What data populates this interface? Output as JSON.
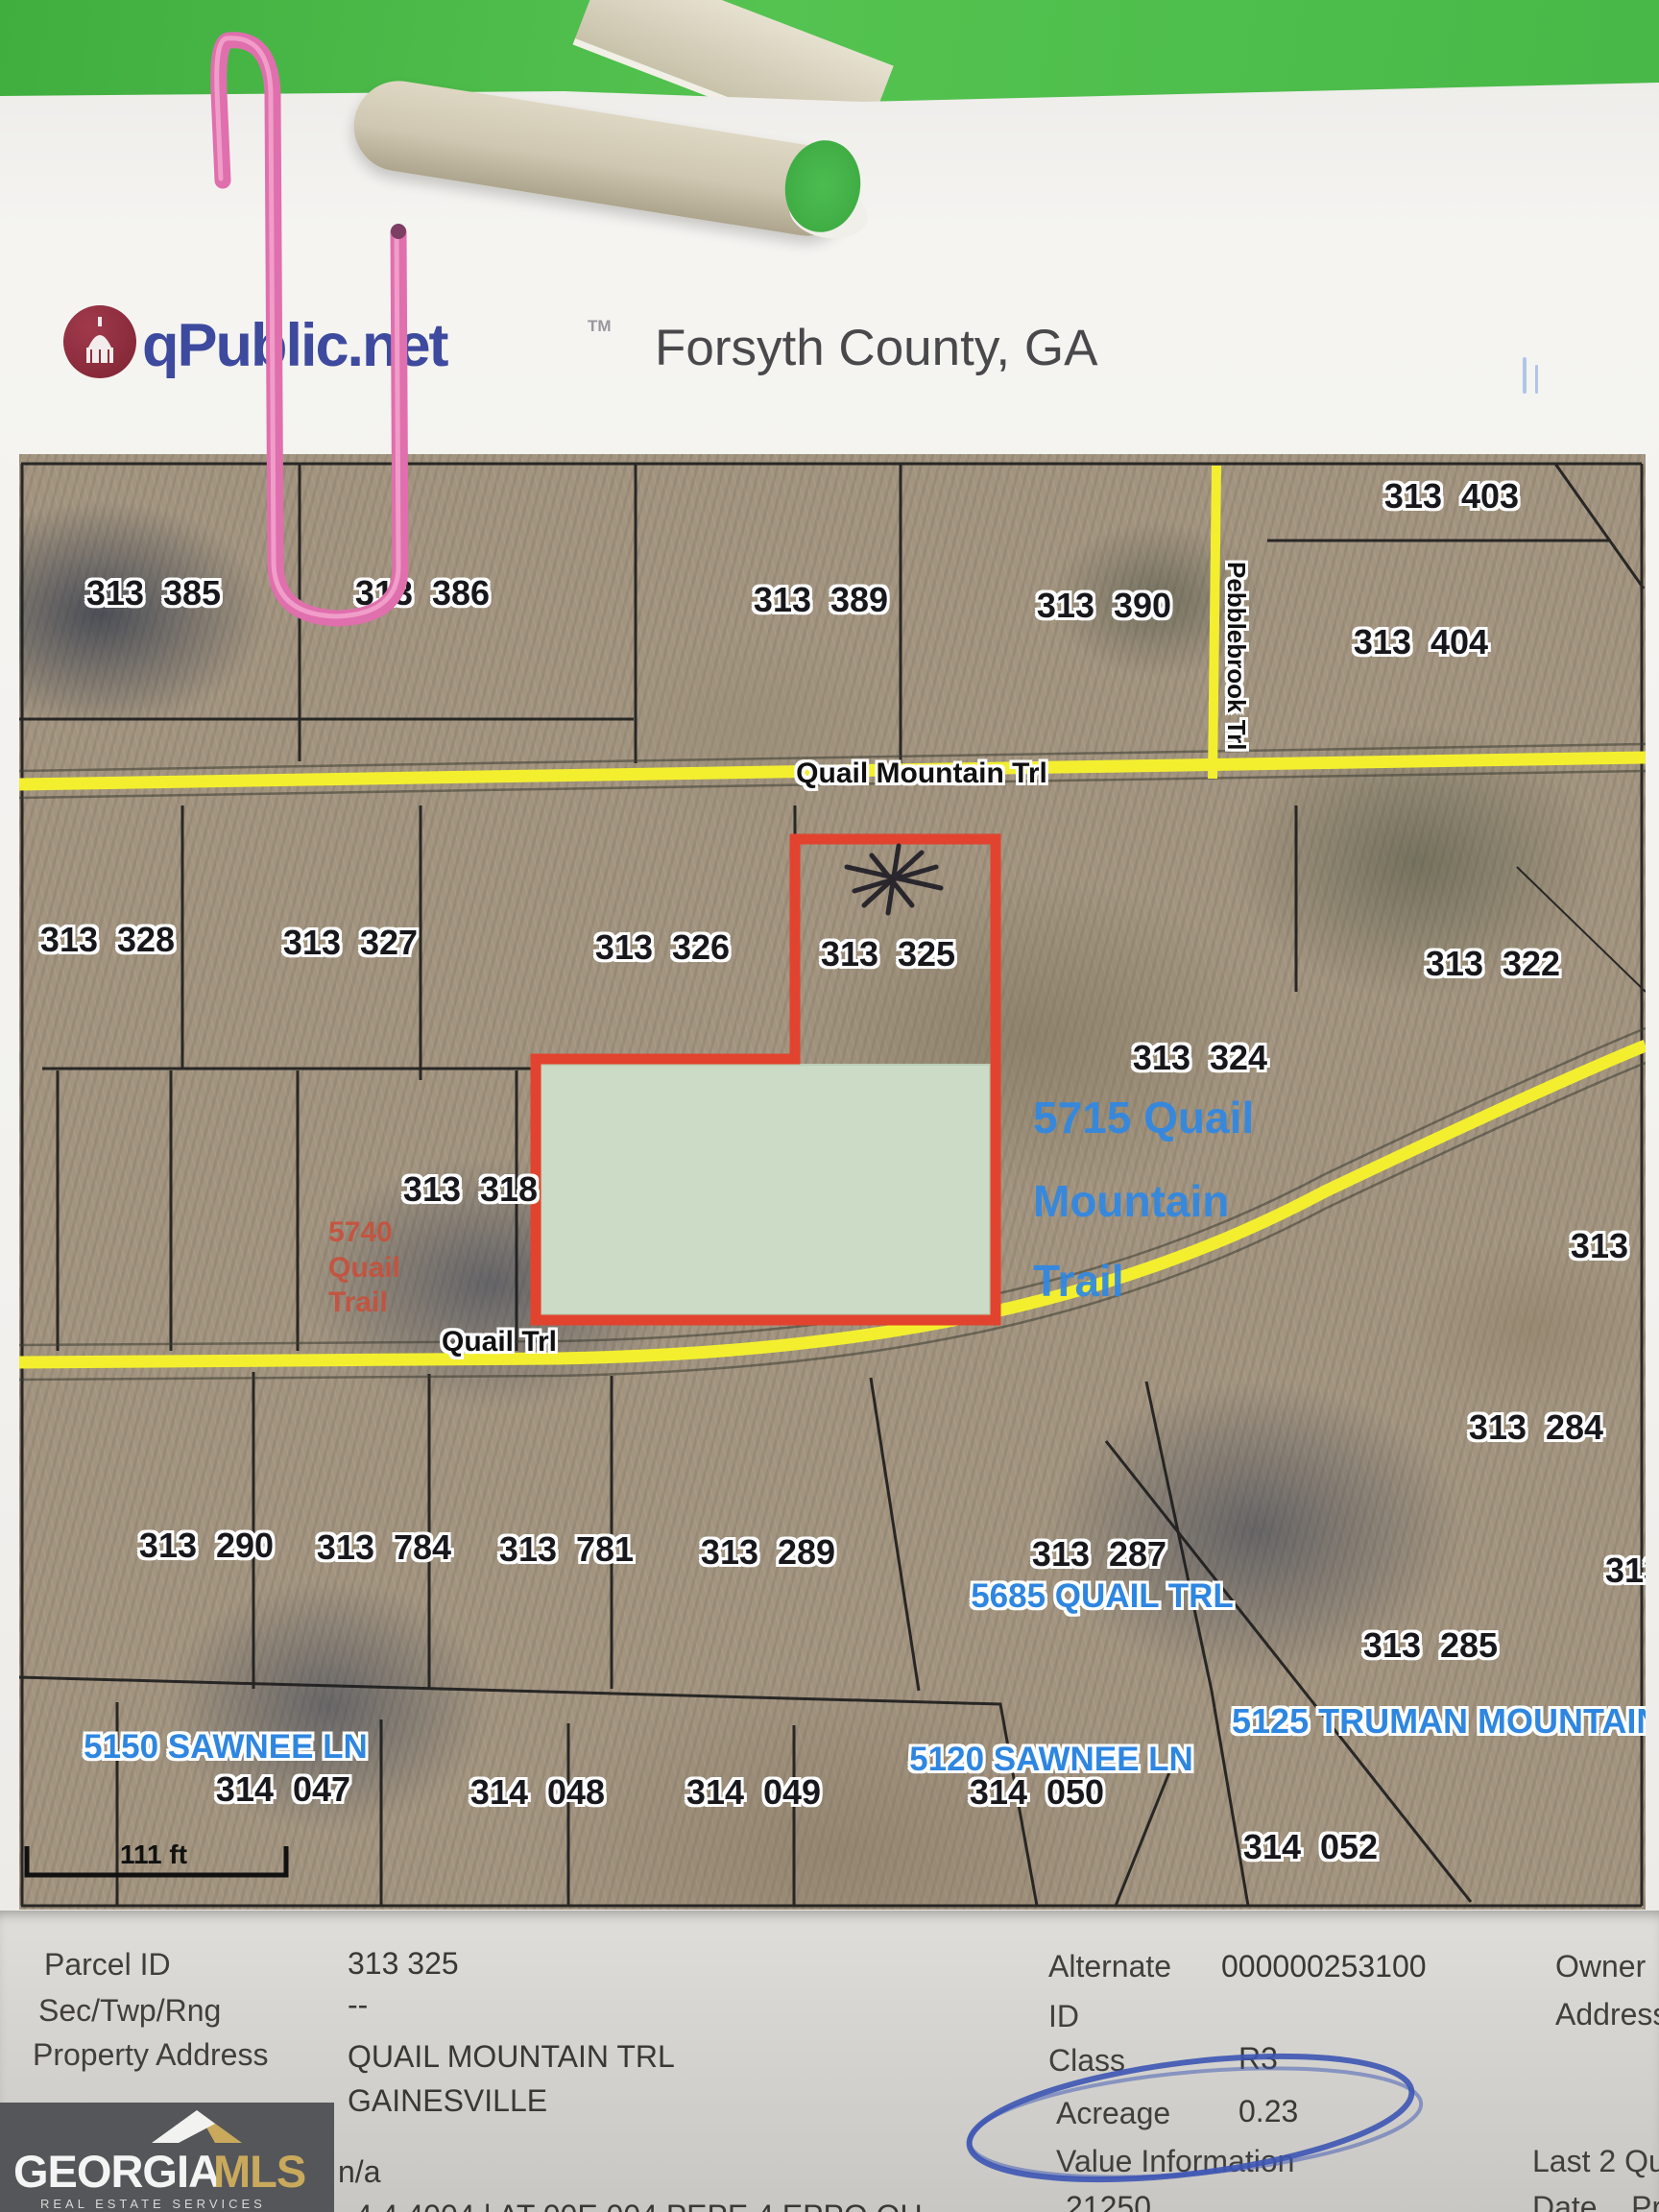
{
  "header": {
    "brand": "qPublic.net",
    "trademark": "TM",
    "region": "Forsyth County, GA"
  },
  "map": {
    "parcels": [
      {
        "text": "313  385"
      },
      {
        "text": "313  386"
      },
      {
        "text": "313  389"
      },
      {
        "text": "313  390"
      },
      {
        "text": "313  403"
      },
      {
        "text": "313  404"
      },
      {
        "text": "313  328"
      },
      {
        "text": "313  327"
      },
      {
        "text": "313  326"
      },
      {
        "text": "313  325"
      },
      {
        "text": "313  322"
      },
      {
        "text": "313  324"
      },
      {
        "text": "313  318"
      },
      {
        "text": "313  282"
      },
      {
        "text": "313  284"
      },
      {
        "text": "313  290"
      },
      {
        "text": "313  784"
      },
      {
        "text": "313  781"
      },
      {
        "text": "313  289"
      },
      {
        "text": "313  287"
      },
      {
        "text": "313  285"
      },
      {
        "text": "313  2"
      },
      {
        "text": "314  047"
      },
      {
        "text": "314  048"
      },
      {
        "text": "314  049"
      },
      {
        "text": "314  050"
      },
      {
        "text": "314  052"
      }
    ],
    "roads": {
      "quail_mountain": "Quail Mountain Trl",
      "pebblebrook": "Pebblebrook Trl",
      "quail": "Quail Trl"
    },
    "addresses": {
      "a5715_line1": "5715 Quail",
      "a5715_line2": "Mountain",
      "a5715_line3": "Trail",
      "a5740_line1": "5740",
      "a5740_line2": "Quail",
      "a5740_line3": "Trail",
      "a5685": "5685 QUAIL TRL",
      "a5125": "5125 TRUMAN MOUNTAIN",
      "a5150": "5150 SAWNEE LN",
      "a5120": "5120 SAWNEE LN"
    },
    "scale_label": "111 ft",
    "highlight_colors": {
      "outline": "#e2432e",
      "cover_fill": "#ccdbc5",
      "road_yellow": "#f3ef2f"
    }
  },
  "info": {
    "parcel_id_label": "Parcel ID",
    "parcel_id": "313 325",
    "sec_label": "Sec/Twp/Rng",
    "sec": "--",
    "addr_label": "Property Address",
    "addr1": "QUAIL MOUNTAIN TRL",
    "addr2": "GAINESVILLE",
    "na": "n/a",
    "cropped": "4 4 4004 | AT 00E 004 PEPE 4 EPPO OU",
    "alt_label1": "Alternate",
    "alt_label2": "ID",
    "alt_value": "000000253100",
    "class_label": "Class",
    "class_value": "R3",
    "acreage_label": "Acreage",
    "acreage_value": "0.23",
    "value_info_label": "Value Information",
    "value_info_value": "21250",
    "owner_label": "Owner",
    "address_label": "Address",
    "last2_label": "Last 2 Qua",
    "date_label": "Date    Pr",
    "annotation_color": "#3c55b4"
  },
  "footer_logo": {
    "georgia": "GEORGIA",
    "mls": "MLS",
    "tagline": "REAL ESTATE SERVICES"
  }
}
